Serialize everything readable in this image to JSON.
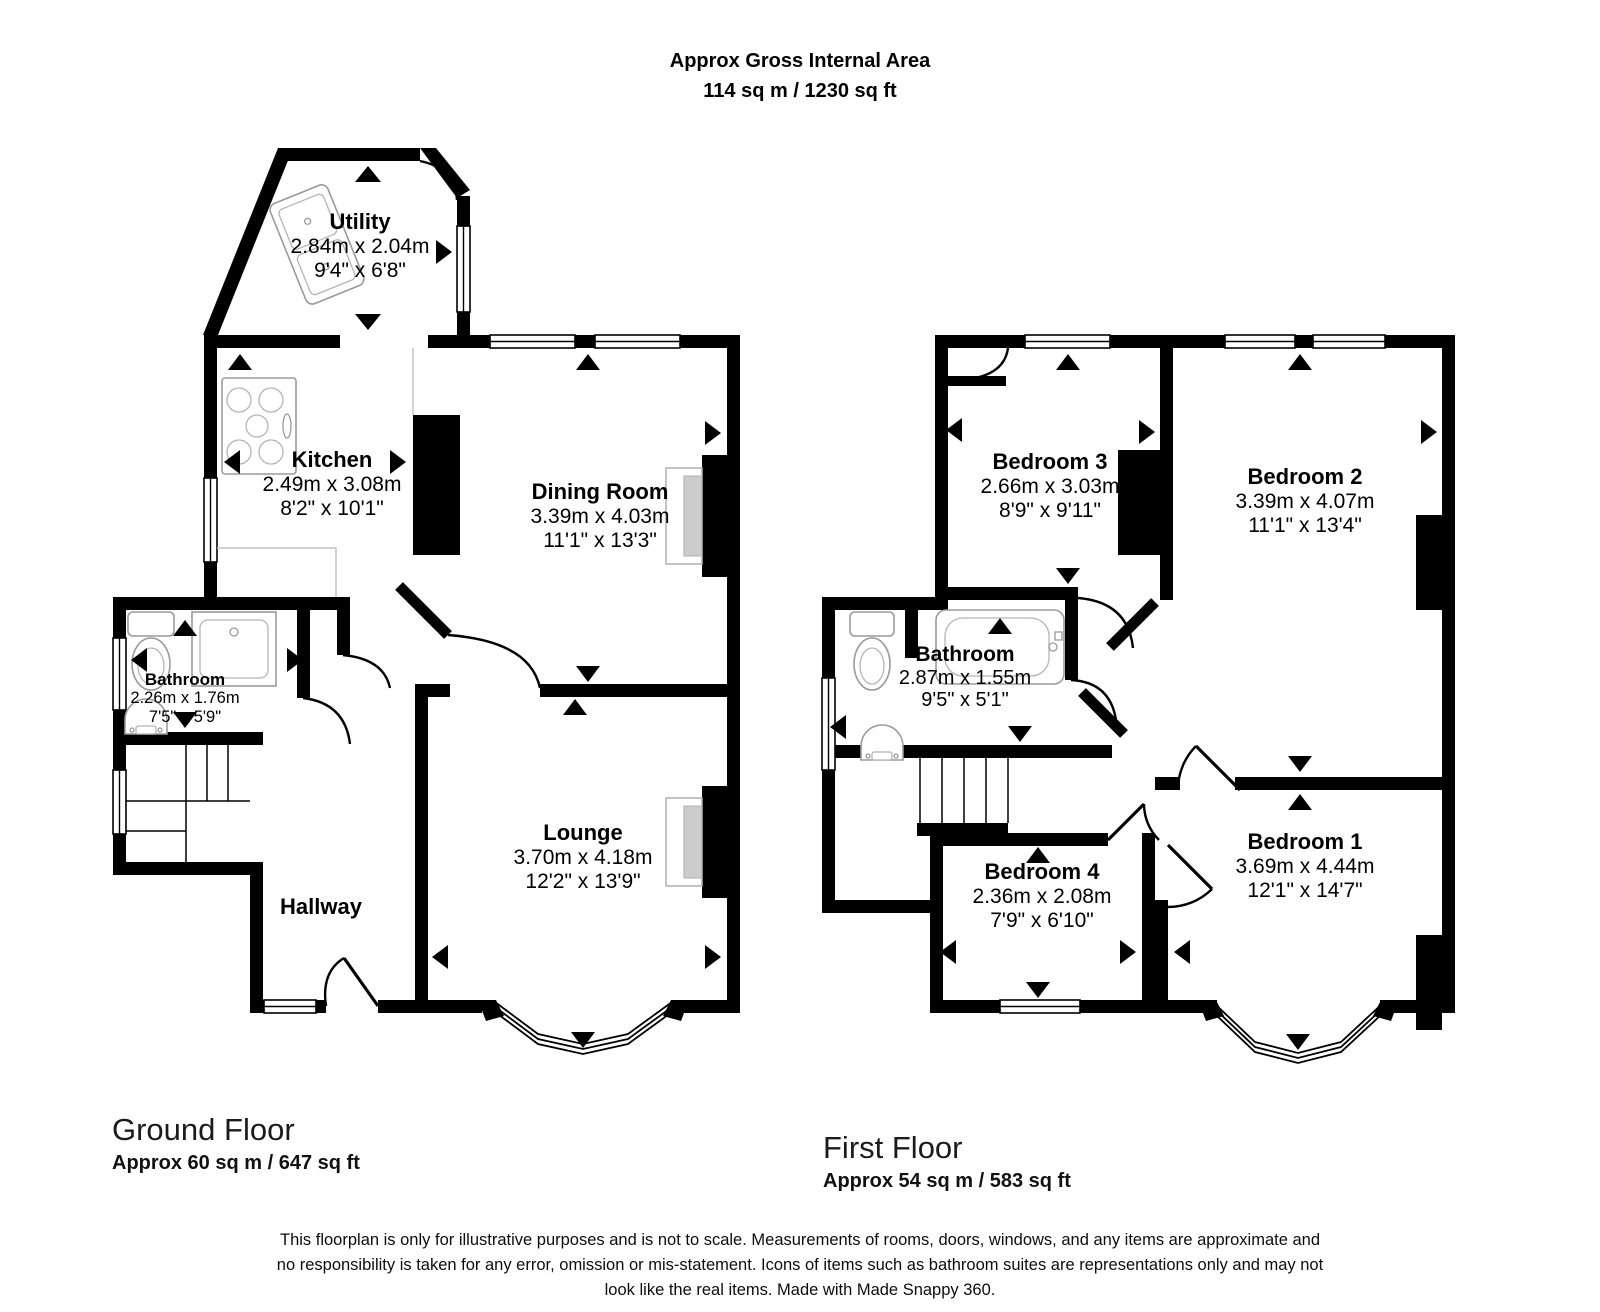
{
  "header": {
    "title": "Approx Gross Internal Area",
    "subtitle": "114 sq m / 1230 sq ft"
  },
  "ground_floor": {
    "label": "Ground Floor",
    "area": "Approx 60 sq m / 647 sq ft",
    "rooms": [
      {
        "name": "Utility",
        "metric": "2.84m x 2.04m",
        "imperial": "9'4\" x 6'8\""
      },
      {
        "name": "Kitchen",
        "metric": "2.49m x 3.08m",
        "imperial": "8'2\" x 10'1\""
      },
      {
        "name": "Dining Room",
        "metric": "3.39m x 4.03m",
        "imperial": "11'1\" x 13'3\""
      },
      {
        "name": "Bathroom",
        "metric": "2.26m x 1.76m",
        "imperial": "7'5\" x 5'9\""
      },
      {
        "name": "Lounge",
        "metric": "3.70m x 4.18m",
        "imperial": "12'2\" x 13'9\""
      },
      {
        "name": "Hallway",
        "metric": "",
        "imperial": ""
      }
    ]
  },
  "first_floor": {
    "label": "First Floor",
    "area": "Approx 54 sq m / 583 sq ft",
    "rooms": [
      {
        "name": "Bedroom 3",
        "metric": "2.66m x 3.03m",
        "imperial": "8'9\" x 9'11\""
      },
      {
        "name": "Bedroom 2",
        "metric": "3.39m x 4.07m",
        "imperial": "11'1\" x 13'4\""
      },
      {
        "name": "Bathroom",
        "metric": "2.87m x 1.55m",
        "imperial": "9'5\" x 5'1\""
      },
      {
        "name": "Bedroom 1",
        "metric": "3.69m x 4.44m",
        "imperial": "12'1\" x 14'7\""
      },
      {
        "name": "Bedroom 4",
        "metric": "2.36m x 2.08m",
        "imperial": "7'9\" x 6'10\""
      }
    ]
  },
  "disclaimer": "This floorplan is only for illustrative purposes and is not to scale. Measurements of rooms, doors, windows, and any items are approximate and no responsibility is taken for any error, omission or mis-statement. Icons of items such as bathroom suites are representations only and may not look like the real items. Made with Made Snappy 360."
}
